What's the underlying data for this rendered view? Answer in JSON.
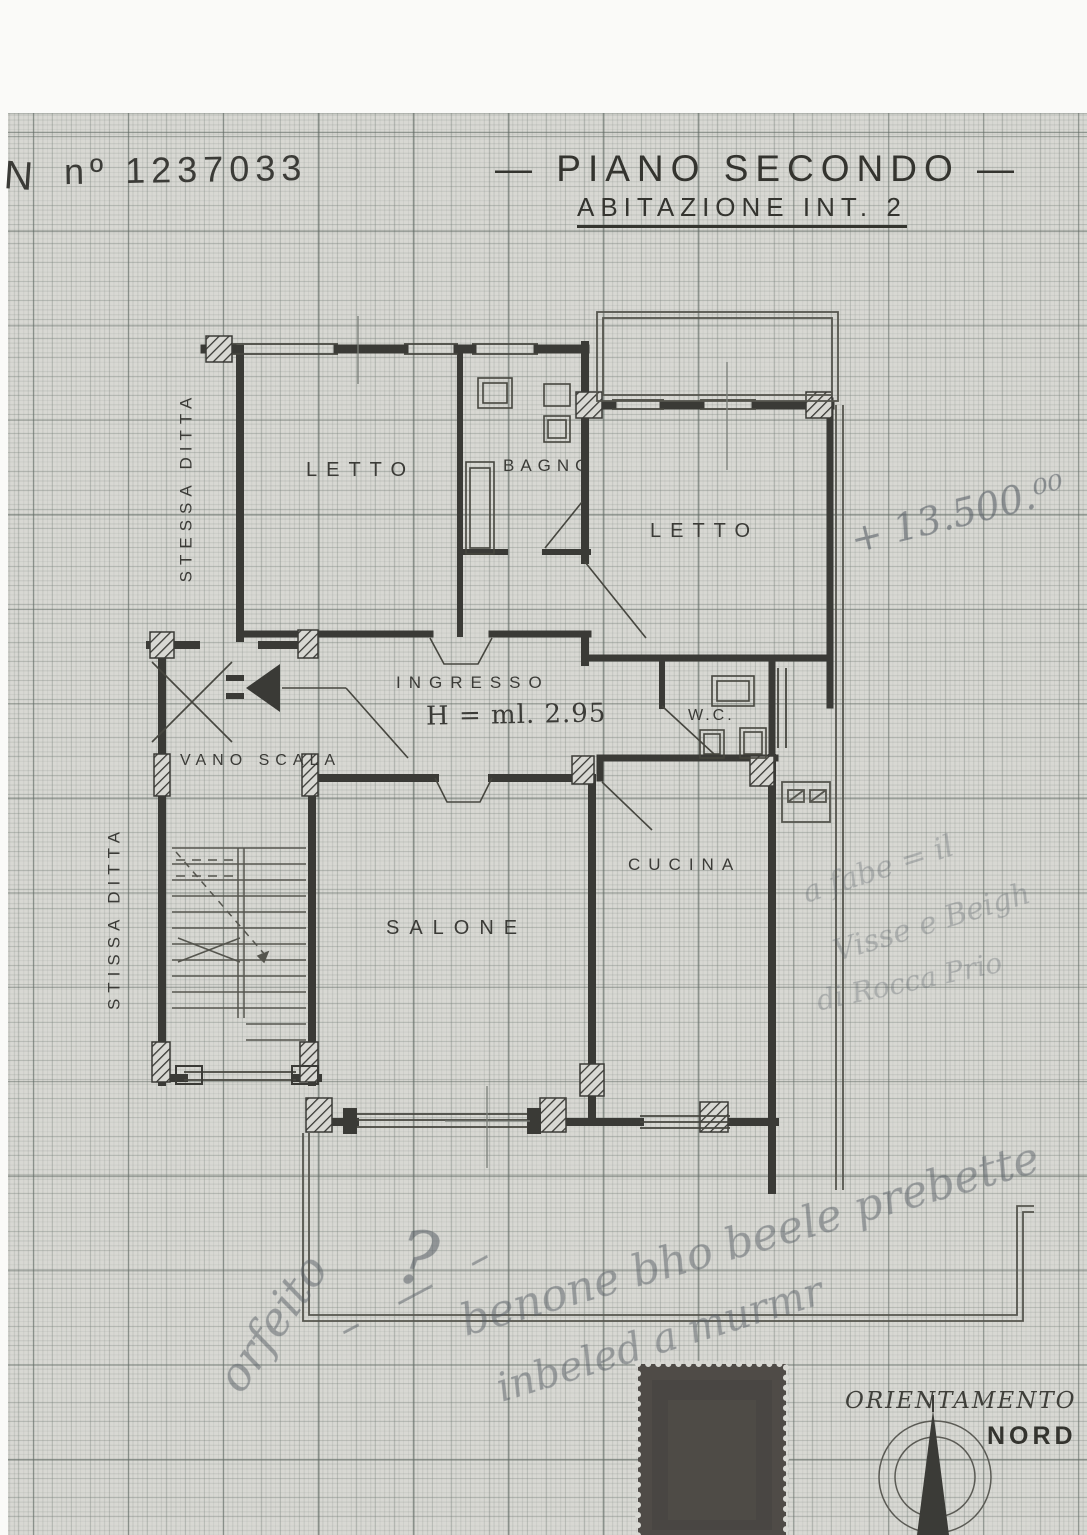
{
  "document": {
    "sheet_prefix": "N",
    "sheet_number": "nº 1237033",
    "title": "— PIANO SECONDO —",
    "subtitle": "ABITAZIONE INT. 2"
  },
  "rooms": {
    "letto1": "LETTO",
    "bagno": "BAGNO",
    "letto2": "LETTO",
    "ingresso": "INGRESSO",
    "ceiling_height": "H = ml. 2.95",
    "wc": "W.C.",
    "vano_scala": "VANO SCALA",
    "salone": "SALONE",
    "cucina": "CUCINA"
  },
  "margin_labels": {
    "upper": "STESSA DITTA",
    "lower": "STISSA DITTA"
  },
  "orientation": {
    "title": "ORIENTAMENTO",
    "north": "NORD"
  },
  "handwritten": {
    "price": "+ 13.500.⁰⁰",
    "question_mark": "?",
    "right_note_line1": "a fabe = il",
    "right_note_line2": "Visse e Beigh",
    "right_note_line3": "di Rocca Prio",
    "bottom_note_word": "orfeito",
    "bottom_note_dashes": "– — –",
    "bottom_note_line1": "benone bho beele prebette",
    "bottom_note_line2": "inbeled a murmr"
  },
  "colors": {
    "paper": "#d8d8d3",
    "ink": "#3a3a36",
    "pencil": "#6a6f74",
    "stamp": "#4f4b47"
  }
}
